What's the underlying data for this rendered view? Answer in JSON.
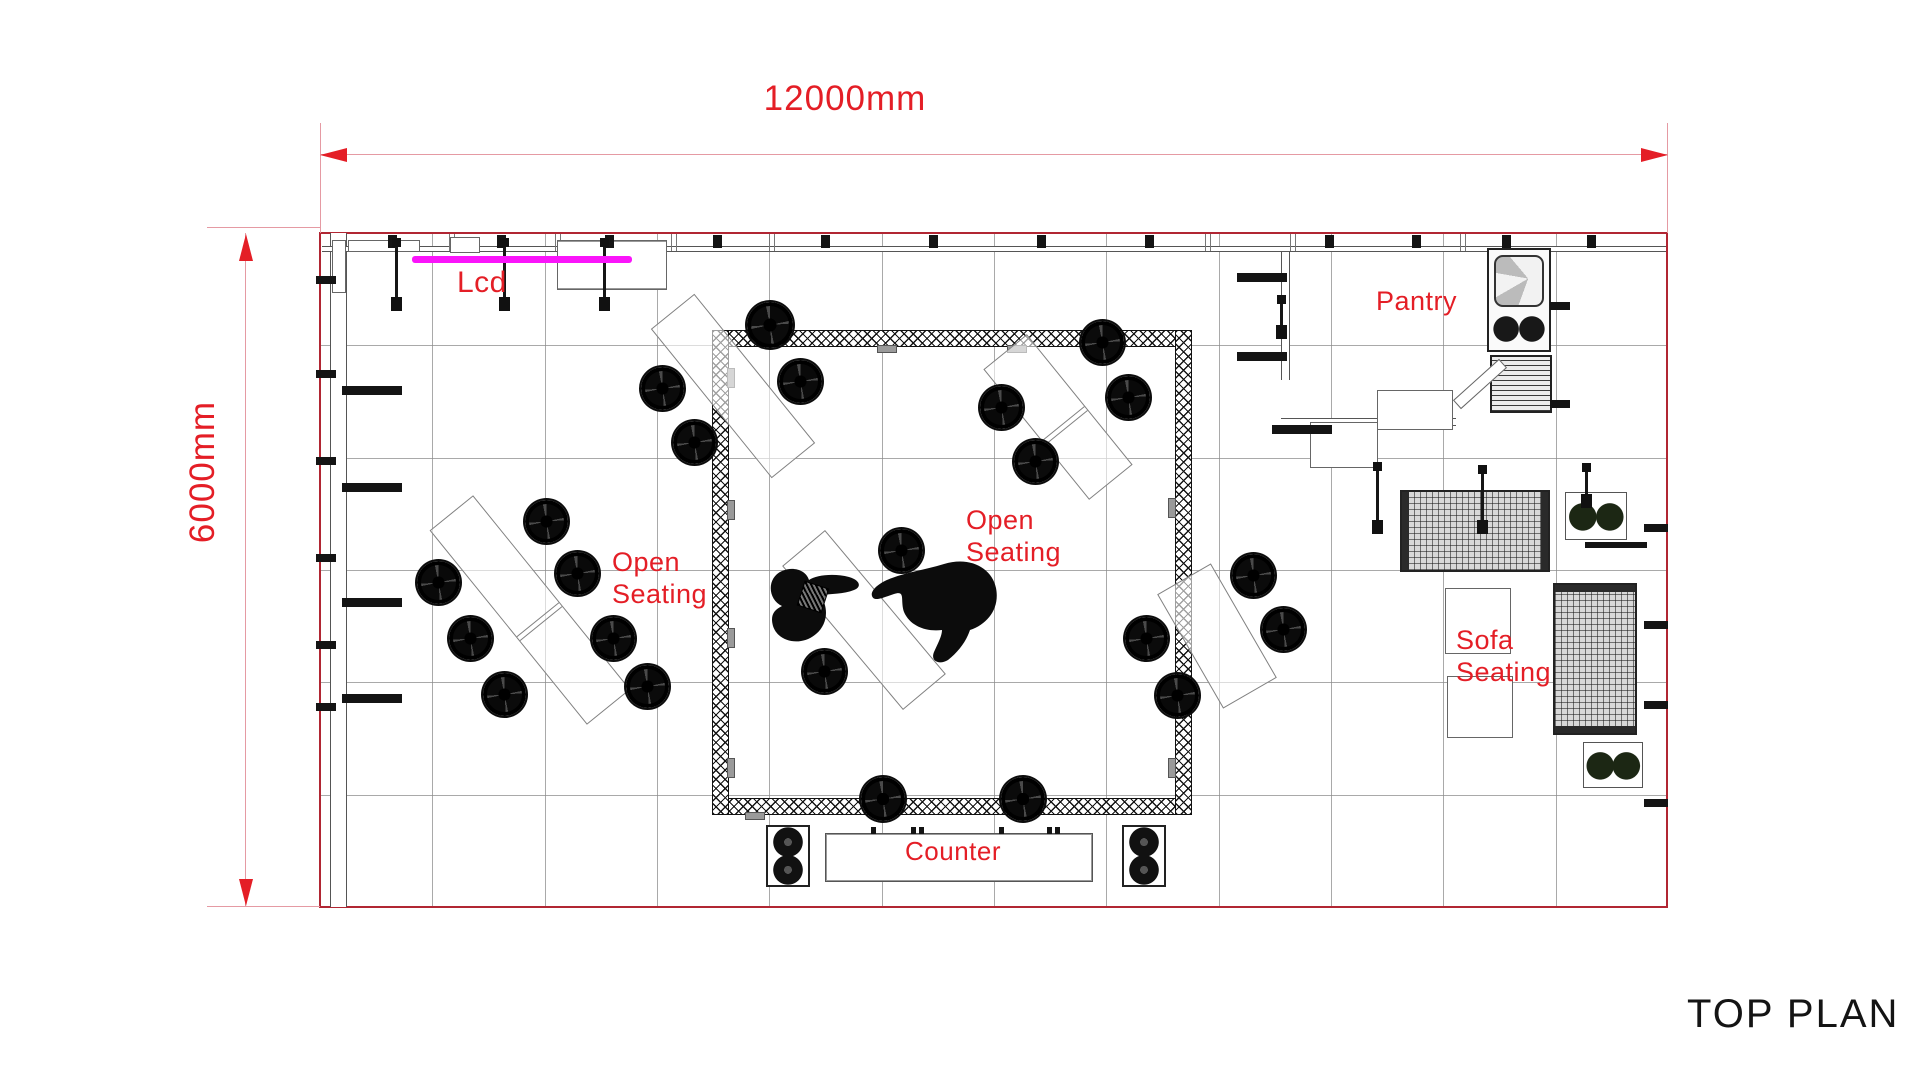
{
  "title": {
    "text": "TOP PLAN"
  },
  "dimensions": {
    "top": {
      "label": "12000mm",
      "value_mm": 12000
    },
    "left": {
      "label": "6000mm",
      "value_mm": 6000
    }
  },
  "colors": {
    "accent_red": "#e41e26",
    "magenta": "#fa14fa",
    "plan_border": "#b12633",
    "grid": "#8c8c8c",
    "ink": "#141414"
  },
  "labels": [
    {
      "id": "lcd",
      "text": "Lcd",
      "x": 457,
      "y": 266,
      "s": 30
    },
    {
      "id": "open-seating-left",
      "text": "Open\nSeating",
      "x": 612,
      "y": 546,
      "s": 27,
      "lh": 32
    },
    {
      "id": "open-seating-right",
      "text": "Open\nSeating",
      "x": 966,
      "y": 504,
      "s": 27,
      "lh": 32
    },
    {
      "id": "pantry",
      "text": "Pantry",
      "x": 1376,
      "y": 286,
      "s": 27
    },
    {
      "id": "sofa-seating",
      "text": "Sofa\nSeating",
      "x": 1456,
      "y": 624,
      "s": 27,
      "lh": 32
    },
    {
      "id": "counter",
      "text": "Counter",
      "x": 905,
      "y": 836,
      "s": 26
    }
  ],
  "plan": {
    "x": 320,
    "y": 233,
    "w": 1348,
    "h": 674,
    "cols": 12,
    "rows": 6,
    "boxes": [
      [
        "wall-v",
        "left-wall",
        330,
        233,
        17,
        674
      ],
      [
        "wall-h",
        "top-wall-line",
        322,
        246,
        1344,
        6
      ],
      [
        "wall-v",
        "pantry-wall-left",
        1281,
        252,
        9,
        128
      ],
      [
        "wall-h",
        "pantry-wall-bottom",
        1281,
        418,
        175,
        8
      ],
      [
        "truss",
        "truss-bar-top",
        712,
        330,
        480,
        17
      ],
      [
        "truss",
        "truss-bar-bottom",
        712,
        798,
        480,
        17
      ],
      [
        "truss",
        "truss-bar-left",
        712,
        330,
        17,
        485
      ],
      [
        "truss",
        "truss-bar-right",
        1175,
        330,
        17,
        485
      ],
      [
        "shelf",
        "wall-shelf",
        348,
        240,
        72,
        12
      ],
      [
        "shelf",
        "wall-shelf",
        450,
        237,
        30,
        16
      ],
      [
        "cabinet",
        "wall-cabinet",
        557,
        240,
        110,
        50
      ],
      [
        "shelf",
        "wall-shelf",
        332,
        240,
        14,
        53
      ],
      [
        "lcd-line",
        "lcd-screen-line",
        412,
        256,
        220,
        7
      ],
      [
        "pantry-table",
        "pantry-table",
        1377,
        390,
        76,
        40
      ],
      [
        "pantry-table",
        "pantry-table",
        1310,
        422,
        68,
        46
      ],
      [
        "sink-unit",
        "pantry-sink-stove",
        1487,
        248,
        64,
        104
      ],
      [
        "fridge",
        "pantry-fridge",
        1490,
        355,
        62,
        58
      ],
      [
        "plank",
        "pantry-board",
        1449,
        378,
        62,
        12,
        -42
      ],
      [
        "sofa-h",
        "sofa-horizontal",
        1400,
        490,
        150,
        82
      ],
      [
        "sofa-v",
        "sofa-vertical",
        1553,
        583,
        84,
        152
      ],
      [
        "coffee-table",
        "coffee-table",
        1445,
        588,
        66,
        66
      ],
      [
        "coffee-table",
        "coffee-table",
        1447,
        676,
        66,
        62
      ],
      [
        "plant-table",
        "plant-table",
        1565,
        492,
        62,
        48
      ],
      [
        "plant-table",
        "plant-table",
        1583,
        742,
        60,
        46
      ],
      [
        "counter",
        "counter-table",
        825,
        833,
        268,
        49
      ],
      [
        "speaker",
        "speaker-cabinet",
        766,
        825,
        44,
        62
      ],
      [
        "speaker",
        "speaker-cabinet",
        1122,
        825,
        44,
        62
      ],
      [
        "tray",
        "table-tray",
        800,
        584,
        26,
        26,
        18
      ]
    ],
    "ticks": [
      [
        388,
        235,
        9,
        13
      ],
      [
        497,
        235,
        9,
        13
      ],
      [
        605,
        235,
        9,
        13
      ],
      [
        713,
        235,
        9,
        13
      ],
      [
        821,
        235,
        9,
        13
      ],
      [
        929,
        235,
        9,
        13
      ],
      [
        1037,
        235,
        9,
        13
      ],
      [
        1145,
        235,
        9,
        13
      ],
      [
        1325,
        235,
        9,
        13
      ],
      [
        1412,
        235,
        9,
        13
      ],
      [
        1502,
        235,
        9,
        13
      ],
      [
        1587,
        235,
        9,
        13
      ],
      [
        316,
        276,
        20,
        8
      ],
      [
        316,
        370,
        20,
        8
      ],
      [
        316,
        457,
        20,
        8
      ],
      [
        316,
        554,
        20,
        8
      ],
      [
        316,
        641,
        20,
        8
      ],
      [
        316,
        703,
        20,
        8
      ],
      [
        342,
        386,
        60,
        9
      ],
      [
        342,
        483,
        60,
        9
      ],
      [
        342,
        598,
        60,
        9
      ],
      [
        342,
        694,
        60,
        9
      ],
      [
        1644,
        524,
        24,
        8
      ],
      [
        1644,
        621,
        24,
        8
      ],
      [
        1644,
        701,
        24,
        8
      ],
      [
        1644,
        799,
        24,
        8
      ],
      [
        1237,
        273,
        50,
        9
      ],
      [
        1237,
        352,
        50,
        9
      ],
      [
        1272,
        425,
        60,
        9
      ],
      [
        1550,
        302,
        20,
        8
      ],
      [
        1550,
        400,
        20,
        8
      ],
      [
        1585,
        542,
        62,
        6
      ],
      [
        871,
        827,
        5,
        7
      ],
      [
        911,
        827,
        5,
        7
      ],
      [
        919,
        827,
        5,
        7
      ],
      [
        999,
        827,
        5,
        7
      ],
      [
        1047,
        827,
        5,
        7
      ],
      [
        1055,
        827,
        5,
        7
      ]
    ],
    "tabs": [
      [
        727,
        368,
        8,
        20
      ],
      [
        727,
        500,
        8,
        20
      ],
      [
        727,
        628,
        8,
        20
      ],
      [
        727,
        758,
        8,
        20
      ],
      [
        1168,
        498,
        8,
        20
      ],
      [
        1168,
        758,
        8,
        20
      ],
      [
        877,
        345,
        20,
        8
      ],
      [
        1007,
        345,
        20,
        8
      ],
      [
        745,
        812,
        20,
        8
      ]
    ],
    "joints": [
      449,
      555,
      671,
      769,
      1205,
      1290,
      1460
    ],
    "rods": [
      [
        395,
        241,
        66
      ],
      [
        503,
        241,
        66
      ],
      [
        603,
        241,
        66
      ],
      [
        1376,
        465,
        65
      ],
      [
        1481,
        468,
        62
      ],
      [
        1585,
        466,
        38
      ],
      [
        1280,
        298,
        37
      ]
    ],
    "tables": [
      [
        530,
        610,
        250,
        56,
        51,
        1
      ],
      [
        733,
        386,
        192,
        56,
        51,
        0
      ],
      [
        864,
        620,
        188,
        56,
        50,
        0
      ],
      [
        1217,
        636,
        132,
        62,
        60,
        0
      ],
      [
        1058,
        417,
        168,
        56,
        51,
        1
      ]
    ],
    "stools": [
      [
        438,
        582
      ],
      [
        470,
        638
      ],
      [
        504,
        694
      ],
      [
        546,
        521
      ],
      [
        577,
        573
      ],
      [
        613,
        638
      ],
      [
        647,
        686
      ],
      [
        662,
        388
      ],
      [
        694,
        442
      ],
      [
        770,
        325,
        46
      ],
      [
        800,
        381
      ],
      [
        824,
        671
      ],
      [
        901,
        550
      ],
      [
        1001,
        407
      ],
      [
        1035,
        461
      ],
      [
        1102,
        342
      ],
      [
        1128,
        397
      ],
      [
        883,
        799,
        44
      ],
      [
        1023,
        799,
        44
      ],
      [
        1146,
        638
      ],
      [
        1177,
        695
      ],
      [
        1253,
        575
      ],
      [
        1283,
        629
      ]
    ]
  }
}
